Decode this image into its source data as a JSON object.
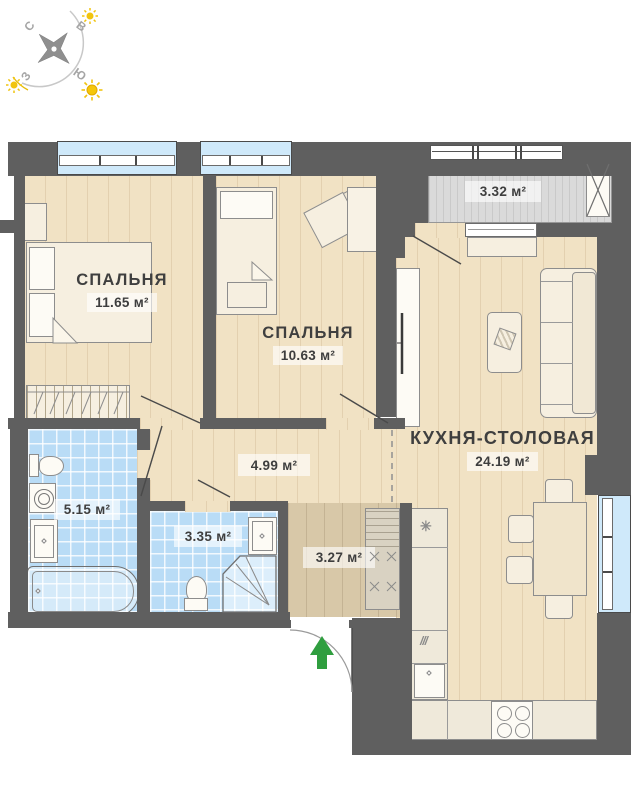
{
  "plan": {
    "bedroom1": {
      "name": "СПАЛЬНЯ",
      "area": "11.65 м²"
    },
    "bedroom2": {
      "name": "СПАЛЬНЯ",
      "area": "10.63 м²"
    },
    "kitchen": {
      "name": "КУХНЯ-СТОЛОВАЯ",
      "area": "24.19 м²"
    },
    "balcony": {
      "area": "3.32 м²"
    },
    "hallway": {
      "area": "4.99 м²"
    },
    "bathroom": {
      "area": "5.15 м²"
    },
    "wc": {
      "area": "3.35 м²"
    },
    "entry": {
      "area": "3.27 м²"
    }
  },
  "compass": {
    "north": "С",
    "east": "В",
    "south": "Ю",
    "west": "З"
  },
  "colors": {
    "wall": "#5f5f5f",
    "wood_floor": "#f1e2c4",
    "entry_floor": "#d8c8a8",
    "tile_floor": "#b9dcf6",
    "window": "#cfe9fa",
    "balcony_floor": "#dadada",
    "entry_arrow": "#2f9e3f",
    "sun": "#f1c40f",
    "label_text": "#3e3e3e"
  }
}
